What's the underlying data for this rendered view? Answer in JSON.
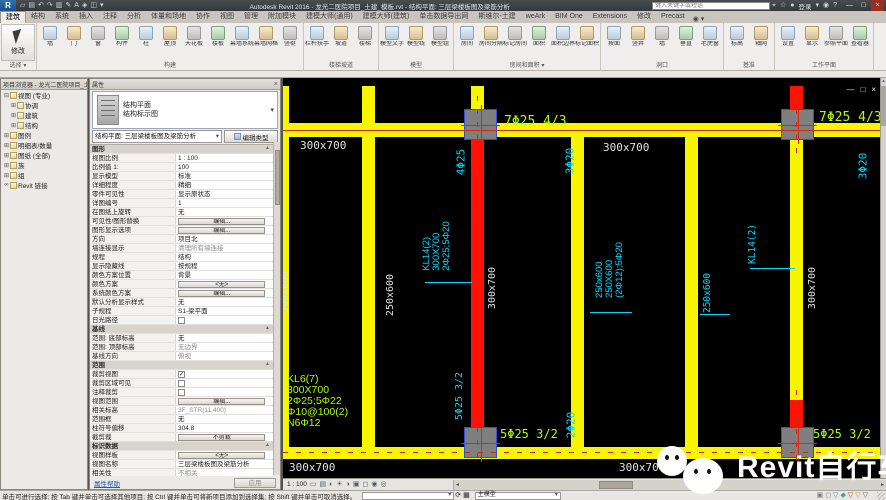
{
  "title_bar": {
    "app_logo": "R",
    "qat_icons": [
      {
        "n": "open-icon",
        "g": "▱"
      },
      {
        "n": "save-icon",
        "g": "▤"
      },
      {
        "n": "undo-icon",
        "g": "↶"
      },
      {
        "n": "redo-icon",
        "g": "↷"
      },
      {
        "n": "print-icon",
        "g": "▥"
      },
      {
        "n": "modify-pencil-icon",
        "g": "✎"
      },
      {
        "n": "text-icon",
        "g": "A"
      },
      {
        "n": "3d-view-icon",
        "g": "◈"
      },
      {
        "n": "section-icon",
        "g": "◫"
      },
      {
        "n": "qat-caret-icon",
        "g": "▾"
      }
    ],
    "app_title": "Autodesk Revit 2016 - 龙光二医院项目_土建_模板.rvt - 结构平面: 三层梁楼板图及梁筋分析",
    "search_placeholder": "键入关键字或短语",
    "right_icons_a": [
      {
        "n": "search-binoculars-icon",
        "g": "⌖"
      },
      {
        "n": "favorites-star-icon",
        "g": "☆"
      },
      {
        "n": "sign-in-icon",
        "g": "●"
      }
    ],
    "signin_label": "登录",
    "right_icons_b": [
      {
        "n": "account-caret-icon",
        "g": "▾"
      },
      {
        "n": "exchange-icon",
        "g": "◉"
      },
      {
        "n": "help-icon",
        "g": "?"
      }
    ],
    "window_buttons": [
      {
        "n": "minimize-icon",
        "g": "—"
      },
      {
        "n": "restore-icon",
        "g": "□"
      },
      {
        "n": "close-icon",
        "g": "×"
      }
    ]
  },
  "ribbon": {
    "active_tab": "建筑",
    "tabs": [
      "建筑",
      "结构",
      "系统",
      "插入",
      "注释",
      "分析",
      "体量和场地",
      "协作",
      "视图",
      "管理",
      "附加模块",
      "建模大师(通用)",
      "建模大师(建筑)",
      "单击数据导出网",
      "斯维尔-土建",
      "weArk",
      "BIM One",
      "Extensions",
      "修改",
      "Precast"
    ],
    "tab_extra": "◉ ▾",
    "groups": [
      {
        "label": "选择 ▾",
        "big": "修改",
        "buttons": []
      },
      {
        "label": "构建",
        "buttons": [
          "墙",
          "门",
          "窗",
          "构件",
          "柱",
          "屋顶",
          "天花板",
          "楼板",
          "幕墙系统",
          "幕墙网格",
          "竖梃"
        ]
      },
      {
        "label": "楼梯坡道",
        "buttons": [
          "栏杆扶手",
          "坡道",
          "楼梯"
        ]
      },
      {
        "label": "模型",
        "buttons": [
          "模型文字",
          "模型线",
          "模型组"
        ]
      },
      {
        "label": "房间和面积 ▾",
        "buttons": [
          "房间",
          "房间分隔",
          "标记房间",
          "面积",
          "面积边界",
          "标记面积"
        ]
      },
      {
        "label": "洞口",
        "buttons": [
          "按面",
          "竖井",
          "墙",
          "垂直",
          "老虎窗"
        ]
      },
      {
        "label": "基准",
        "buttons": [
          "标高",
          "轴网"
        ]
      },
      {
        "label": "工作平面",
        "buttons": [
          "设置",
          "显示",
          "参照平面",
          "查看器"
        ]
      }
    ]
  },
  "project_browser": {
    "title": "项目浏览器 - 龙光二医院项目_土建_模板.rvt",
    "items": [
      {
        "l": "视图 (专业)",
        "d": 0,
        "e": "⊟"
      },
      {
        "l": "协调",
        "d": 1,
        "e": "⊞"
      },
      {
        "l": "建筑",
        "d": 1,
        "e": "⊞"
      },
      {
        "l": "结构",
        "d": 1,
        "e": "⊞"
      },
      {
        "l": "图例",
        "d": 0,
        "e": "⊞"
      },
      {
        "l": "明细表/数量",
        "d": 0,
        "e": "⊞"
      },
      {
        "l": "图纸 (全部)",
        "d": 0,
        "e": "⊞"
      },
      {
        "l": "族",
        "d": 0,
        "e": "⊞"
      },
      {
        "l": "组",
        "d": 0,
        "e": "⊞"
      },
      {
        "l": "Revit 链接",
        "d": 0,
        "e": "∞"
      }
    ]
  },
  "properties": {
    "title": "属性",
    "type_family": "结构平面",
    "type_name": "结构标示图",
    "instance_selector": "结构平面: 三层梁楼板图及梁筋分析",
    "edit_type_label": "编辑类型",
    "rows": [
      {
        "k": "s",
        "l": "图形"
      },
      {
        "l": "视图比例",
        "v": "1 : 100"
      },
      {
        "l": "比例值 1:",
        "v": "100"
      },
      {
        "l": "显示模型",
        "v": "标准"
      },
      {
        "l": "详细程度",
        "v": "精细"
      },
      {
        "l": "零件可见性",
        "v": "显示原状态"
      },
      {
        "l": "详图编号",
        "v": "1"
      },
      {
        "l": "在图纸上旋转",
        "v": "无"
      },
      {
        "l": "可见性/图形替换",
        "v": "编辑...",
        "k": "b"
      },
      {
        "l": "图形显示选项",
        "v": "编辑...",
        "k": "b"
      },
      {
        "l": "方向",
        "v": "项目北"
      },
      {
        "l": "墙连接显示",
        "v": "清理所有墙连接",
        "k": "g"
      },
      {
        "l": "规程",
        "v": "结构"
      },
      {
        "l": "显示隐藏线",
        "v": "按规程"
      },
      {
        "l": "颜色方案位置",
        "v": "背景"
      },
      {
        "l": "颜色方案",
        "v": "<无>",
        "k": "b"
      },
      {
        "l": "系统颜色方案",
        "v": "编辑...",
        "k": "b"
      },
      {
        "l": "默认分析显示样式",
        "v": "无"
      },
      {
        "l": "子规程",
        "v": "S1-梁平面"
      },
      {
        "l": "日光路径",
        "v": "",
        "k": "c0"
      },
      {
        "k": "s",
        "l": "基线"
      },
      {
        "l": "范围: 底部标高",
        "v": "无"
      },
      {
        "l": "范围: 顶部标高",
        "v": "无边界",
        "k": "g"
      },
      {
        "l": "基线方向",
        "v": "俯视",
        "k": "g"
      },
      {
        "k": "s",
        "l": "范围"
      },
      {
        "l": "裁剪视图",
        "v": "",
        "k": "c1"
      },
      {
        "l": "裁剪区域可见",
        "v": "",
        "k": "c0"
      },
      {
        "l": "注释裁剪",
        "v": "",
        "k": "c0"
      },
      {
        "l": "视图范围",
        "v": "编辑...",
        "k": "b"
      },
      {
        "l": "相关标高",
        "v": "3F_STR(11.400)",
        "k": "g"
      },
      {
        "l": "范围框",
        "v": "无"
      },
      {
        "l": "柱符号偏移",
        "v": "304.8"
      },
      {
        "l": "截剪裁",
        "v": "不剪裁",
        "k": "b"
      },
      {
        "k": "s",
        "l": "标识数据"
      },
      {
        "l": "视图样板",
        "v": "<无>",
        "k": "b"
      },
      {
        "l": "视图名称",
        "v": "三层梁楼板图及梁筋分析"
      },
      {
        "l": "相关性",
        "v": "不相关",
        "k": "g"
      }
    ],
    "help_label": "属性帮助",
    "apply_label": "应用"
  },
  "drawing": {
    "colors": {
      "Y": "#f8f500",
      "R": "#ff1206",
      "grid": "#d02a10",
      "cyan": "#00d8ff",
      "green": "#aaff00",
      "white": "#e2e2e2"
    },
    "beams": [
      {
        "x": 0,
        "y": 45,
        "w": 597,
        "h": 14,
        "c": "Y"
      },
      {
        "x": 0,
        "y": 369,
        "w": 597,
        "h": 12,
        "c": "Y"
      },
      {
        "x": 0,
        "y": 8,
        "w": 6,
        "h": 373,
        "c": "Y"
      },
      {
        "x": 79,
        "y": 8,
        "w": 13,
        "h": 373,
        "c": "Y"
      },
      {
        "x": 188,
        "y": 8,
        "w": 13,
        "h": 24,
        "c": "Y"
      },
      {
        "x": 188,
        "y": 62,
        "w": 13,
        "h": 288,
        "c": "R"
      },
      {
        "x": 288,
        "y": 59,
        "w": 13,
        "h": 322,
        "c": "Y"
      },
      {
        "x": 402,
        "y": 59,
        "w": 13,
        "h": 322,
        "c": "Y"
      },
      {
        "x": 507,
        "y": 8,
        "w": 13,
        "h": 24,
        "c": "R"
      },
      {
        "x": 507,
        "y": 62,
        "w": 13,
        "h": 260,
        "c": "Y"
      },
      {
        "x": 507,
        "y": 322,
        "w": 13,
        "h": 28,
        "c": "R"
      }
    ],
    "columns": [
      {
        "x": 181,
        "y": 31,
        "w": 33,
        "h": 31
      },
      {
        "x": 498,
        "y": 31,
        "w": 33,
        "h": 31
      },
      {
        "x": 181,
        "y": 349,
        "w": 33,
        "h": 31
      },
      {
        "x": 498,
        "y": 349,
        "w": 33,
        "h": 31
      }
    ],
    "gridlines": [
      {
        "o": "h",
        "x": 0,
        "y": 52,
        "len": 597,
        "dash": false
      },
      {
        "o": "h",
        "x": 0,
        "y": 374,
        "len": 597,
        "dash": true
      },
      {
        "o": "v",
        "x": 194,
        "y": 18,
        "len": 60,
        "dash": true
      },
      {
        "o": "v",
        "x": 194,
        "y": 336,
        "len": 52,
        "dash": true
      },
      {
        "o": "v",
        "x": 513,
        "y": 18,
        "len": 60,
        "dash": true
      },
      {
        "o": "v",
        "x": 513,
        "y": 312,
        "len": 76,
        "dash": true
      }
    ],
    "leaders": [
      {
        "x": 142,
        "y": 204,
        "w": 47
      },
      {
        "x": 467,
        "y": 190,
        "w": 45
      },
      {
        "x": 307,
        "y": 234,
        "w": 42
      },
      {
        "x": 417,
        "y": 236,
        "w": 30
      }
    ],
    "labels": [
      {
        "text": "300x700",
        "x": 17,
        "y": 62,
        "c": "W",
        "s": 11
      },
      {
        "text": "300x700",
        "x": 320,
        "y": 64,
        "c": "W",
        "s": 11
      },
      {
        "text": "300x700",
        "x": 6,
        "y": 384,
        "c": "W",
        "s": 11
      },
      {
        "text": "300x700",
        "x": 336,
        "y": 384,
        "c": "W",
        "s": 11
      },
      {
        "text": "300x700",
        "x": 210,
        "y": 210,
        "c": "W",
        "s": 10,
        "rot": 1
      },
      {
        "text": "300x700",
        "x": 530,
        "y": 210,
        "c": "W",
        "s": 10,
        "rot": 1
      },
      {
        "text": "300x600",
        "x": 3,
        "y": 214,
        "c": "W",
        "s": 10,
        "rot": 1
      },
      {
        "text": "250x600",
        "x": 108,
        "y": 217,
        "c": "W",
        "s": 10,
        "rot": 1
      },
      {
        "text": "4Φ25",
        "x": 178,
        "y": 84,
        "c": "C",
        "s": 11,
        "rot": 1
      },
      {
        "text": "3Φ20",
        "x": 287,
        "y": 83,
        "c": "C",
        "s": 11,
        "rot": 1
      },
      {
        "text": "3Φ20",
        "x": 580,
        "y": 88,
        "c": "C",
        "s": 11,
        "rot": 1
      },
      {
        "lines": [
          "KL14(2)",
          "300X700",
          "2Φ25;5Φ20"
        ],
        "x": 154,
        "y": 168,
        "c": "C",
        "s": 9.5,
        "rot": 1
      },
      {
        "text": "KL14(2)",
        "x": 470,
        "y": 166,
        "c": "C",
        "s": 9.5,
        "rot": 1
      },
      {
        "lines": [
          "250x600",
          "250X600",
          "(2Φ12);5Φ20"
        ],
        "x": 327,
        "y": 192,
        "c": "C",
        "s": 9.5,
        "rot": 1
      },
      {
        "text": "250x600",
        "x": 425,
        "y": 215,
        "c": "C",
        "s": 9.5,
        "rot": 1
      },
      {
        "text": "2Φ20",
        "x": 288,
        "y": 347,
        "c": "C",
        "s": 11,
        "rot": 1
      },
      {
        "text": "5Φ25 3/2",
        "x": 177,
        "y": 318,
        "c": "C",
        "s": 10,
        "rot": 1
      },
      {
        "text": "7Φ25 4/3",
        "x": 221,
        "y": 37,
        "c": "G",
        "s": 13
      },
      {
        "text": "7Φ25 4/3",
        "x": 536,
        "y": 33,
        "c": "G",
        "s": 13
      },
      {
        "text": "5Φ25 3/2",
        "x": 217,
        "y": 350,
        "c": "G",
        "s": 12
      },
      {
        "text": "5Φ25 3/2",
        "x": 530,
        "y": 350,
        "c": "G",
        "s": 12
      },
      {
        "lines": [
          "KL6(7)",
          "300X700",
          "2Φ25;5Φ22",
          "Φ10@100(2)",
          "N6Φ12"
        ],
        "x": 4,
        "y": 296,
        "c": "G",
        "s": 10.5
      }
    ],
    "window_controls": [
      {
        "n": "view-minimize-icon",
        "g": "—"
      },
      {
        "n": "view-restore-icon",
        "g": "□"
      },
      {
        "n": "view-close-icon",
        "g": "×"
      }
    ]
  },
  "view_control_bar": {
    "scale": "1 : 100",
    "icons": [
      {
        "n": "scale-icon",
        "g": "▭"
      },
      {
        "n": "detail-level-icon",
        "g": "▤"
      },
      {
        "n": "visual-style-icon",
        "g": "◐"
      },
      {
        "n": "sun-path-icon",
        "g": "☀"
      },
      {
        "n": "shadows-icon",
        "g": "◑"
      },
      {
        "n": "crop-view-icon",
        "g": "▣"
      },
      {
        "n": "show-crop-icon",
        "g": "◻"
      },
      {
        "n": "hide-elements-icon",
        "g": "◉"
      },
      {
        "n": "reveal-hidden-icon",
        "g": "◎"
      }
    ]
  },
  "status_bar": {
    "hint": "单击可进行选择; 按 Tab 键并单击可选择其他项目; 按 Ctrl 键并单击可将新项目添加到选择集; 按 Shift 键并单击可取消选择。",
    "worksets_value": "",
    "design_option_value": "主模型",
    "mid_icons": [
      {
        "n": "worksets-icon",
        "g": "⟳"
      },
      {
        "n": "design-options-icon",
        "g": "▦"
      }
    ],
    "right_icons": [
      {
        "n": "editable-only-icon",
        "g": "▣",
        "c": "#7a7a7a"
      },
      {
        "n": "press-drag-icon",
        "g": "◻",
        "c": "#7a7a7a"
      },
      {
        "n": "exclude-options-filter-icon",
        "g": "▽",
        "c": "#4a7ebb"
      },
      {
        "n": "select-links-icon",
        "g": "◆",
        "c": "#3aa0a0"
      },
      {
        "n": "select-underlay-icon",
        "g": "▽",
        "c": "#c0392b"
      },
      {
        "n": "select-pinned-icon",
        "g": "▽",
        "c": "#d98e2b"
      },
      {
        "n": "filter-icon",
        "g": "▽",
        "c": "#555555"
      }
    ]
  },
  "watermark": {
    "text": "Revit自行车"
  }
}
